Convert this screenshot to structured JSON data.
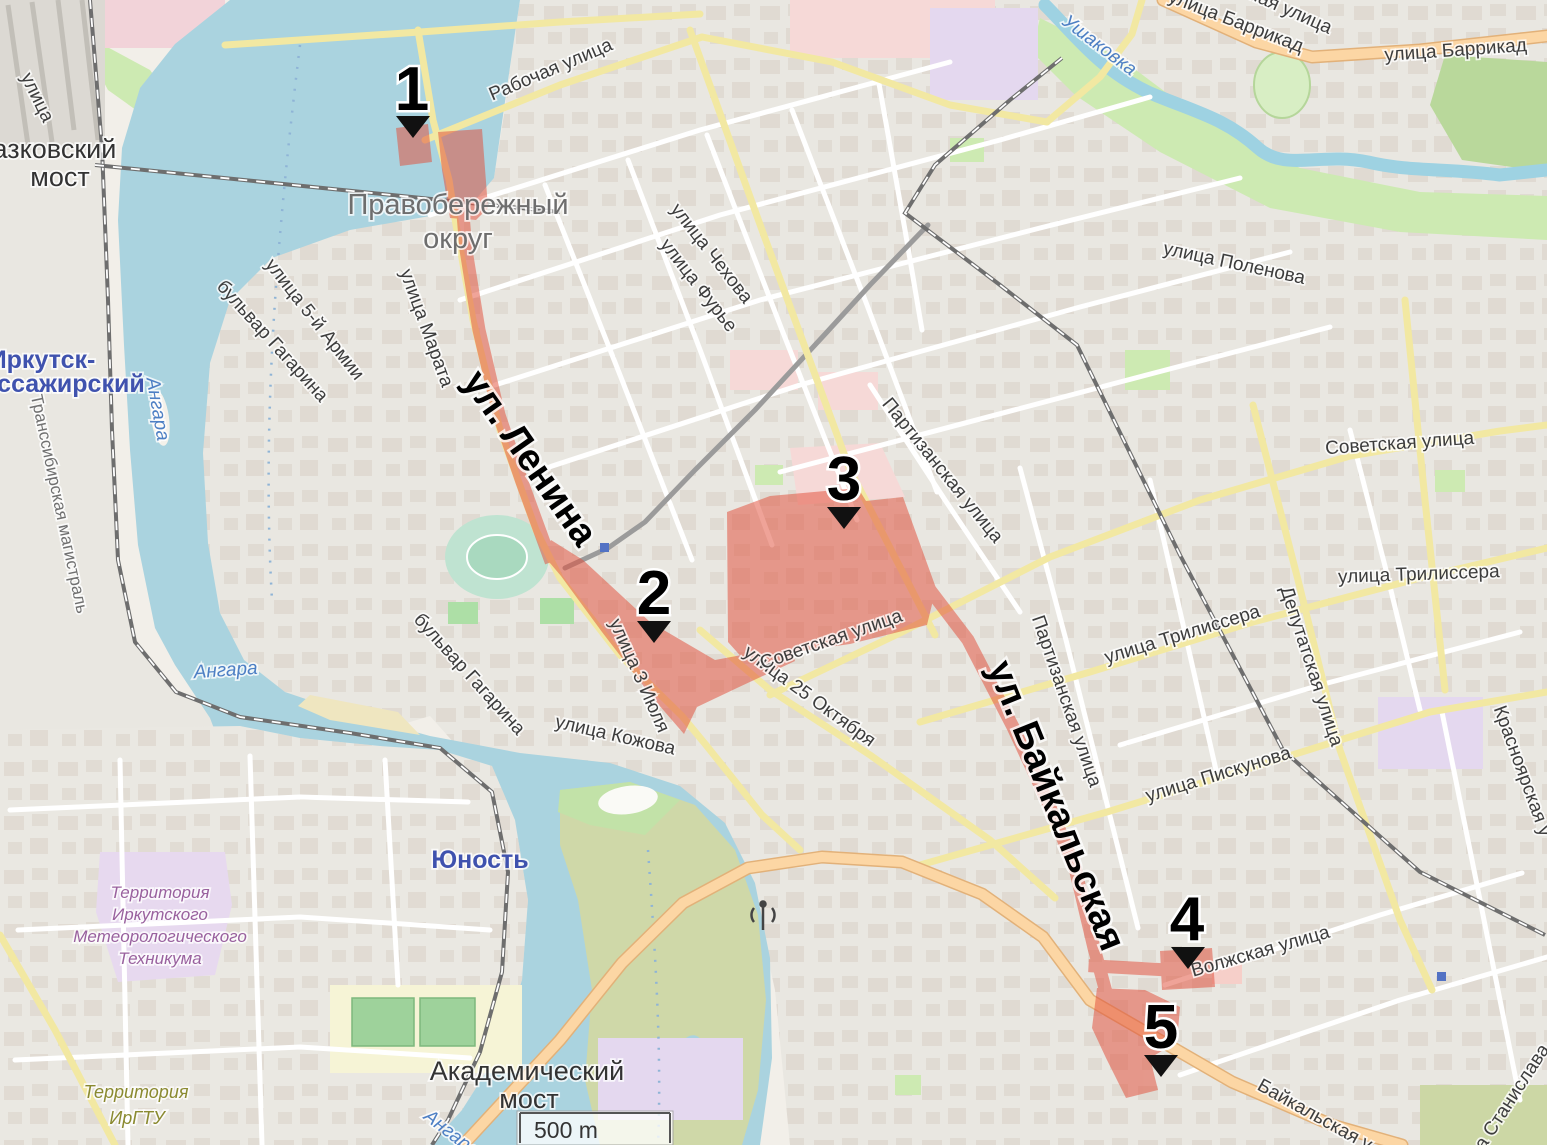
{
  "map": {
    "scale_label": "500 m",
    "colors": {
      "highlight_red": "#e2503c",
      "water": "#aad3df",
      "road_secondary_yellow": "#f2e8a2",
      "road_primary_orange": "#fcd6a4",
      "greenery": "#cdeab2",
      "railway_gray": "#6e6e6e"
    },
    "markers": [
      "1",
      "2",
      "3",
      "4",
      "5"
    ],
    "labels": {
      "street_partial_tl": "улица",
      "glazkovsky_l1": "Глазковский",
      "glazkovsky_l2": "мост",
      "irkutsk_l1": "Иркутск-",
      "irkutsk_l2": "Пассажирский",
      "transsib": "Транссибирская магистраль",
      "angara_vertical": "Ангара",
      "angara_main": "Ангара",
      "angara_bottom": "Ангара",
      "gagarina_upper": "бульвар Гагарина",
      "gagarina_lower": "бульвар Гагарина",
      "armii_5": "улица 5-й Армии",
      "marata": "улица Марата",
      "rabochaya": "Рабочая улица",
      "pravoberezhny_l1": "Правобережный",
      "pravoberezhny_l2": "округ",
      "chekhova": "улица Чехова",
      "furye": "улица Фурье",
      "lenina_big": "ул. Ленина",
      "iyulya_3": "улица 3 Июля",
      "kozhova": "улица Кожова",
      "oktyabrya_25": "улица 25 Октября",
      "sovetskaya_west": "Советская улица",
      "sovetskaya_east": "Советская улица",
      "partizanskaya_north": "Партизанская улица",
      "partizanskaya_south": "Партизанская улица",
      "baikalskaya_big": "ул. Байкальская",
      "trilissera_west": "улица Трилиссера",
      "trilissera_east": "улица Трилиссера",
      "deputatskaya": "Депутатская улица",
      "piskunova": "улица Пискунова",
      "volzhskaya": "Волжская улица",
      "krasnoyarskaya_partial": "Красноярская у",
      "barrikad_diag": "улица Баррикад",
      "barrikad_horiz": "улица Баррикад",
      "naya_partial": "ная улица",
      "ushakovka": "Ушаковка",
      "polenova": "улица Поленова",
      "met_l1": "Территория",
      "met_l2": "Иркутского",
      "met_l3": "Метеорологического",
      "met_l4": "Техникума",
      "irgtu_l1": "Территория",
      "irgtu_l2": "ИрГТУ",
      "yunost": "Юность",
      "akadem_l1": "Академический",
      "akadem_l2": "мост",
      "baikalskaya_street": "Байкальская у",
      "stanislava_partial": "а Станислава"
    }
  }
}
